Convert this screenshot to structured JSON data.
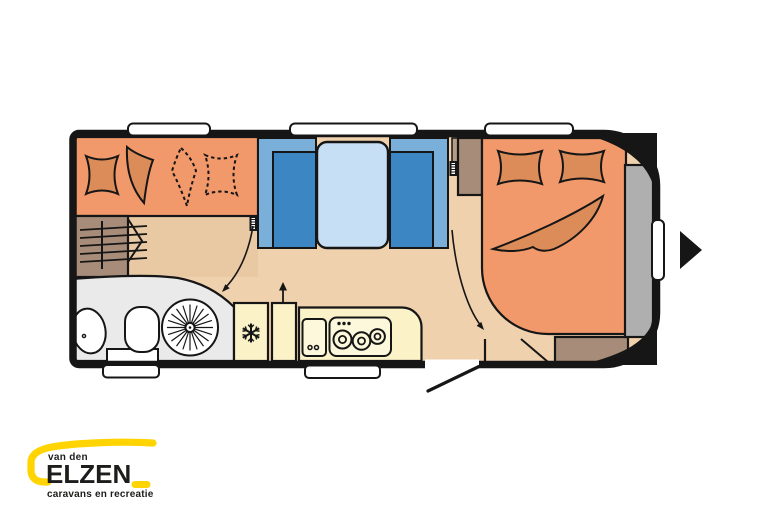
{
  "logo": {
    "prefix": "van den",
    "name": "ELZEN",
    "tagline": "caravans en recreatie"
  },
  "floorplan": {
    "rooms": [
      "front-bed",
      "wardrobe",
      "washroom",
      "dinette",
      "kitchen",
      "fixed-bed",
      "gas-locker"
    ],
    "icons": {
      "fridge": "snowflake",
      "wardrobe": "hanger-rail",
      "shower": "spoked-wheel",
      "hob": "three-burners",
      "entrance": "right-pointing-triangle"
    }
  },
  "colors": {
    "background": "#FFFFFF",
    "outline": "#161616",
    "floor": "#F0D1AE",
    "floor_shadow": "#E9C9A4",
    "bed_orange": "#F1996B",
    "cushion_orange": "#DC8C58",
    "seat_blue": "#3B86C3",
    "seat_blue_light": "#7AAFD9",
    "table_blue": "#C7DFF4",
    "kitchen_yellow": "#FBF2C8",
    "appliance_cream": "#FDF8DC",
    "bathroom_grey": "#EAEAEA",
    "wood_brown": "#A78D79",
    "partition_tan": "#B59C87",
    "locker_grey": "#AFAFAF",
    "logo_yellow": "#FFD400",
    "logo_dark": "#1D1D1B"
  }
}
